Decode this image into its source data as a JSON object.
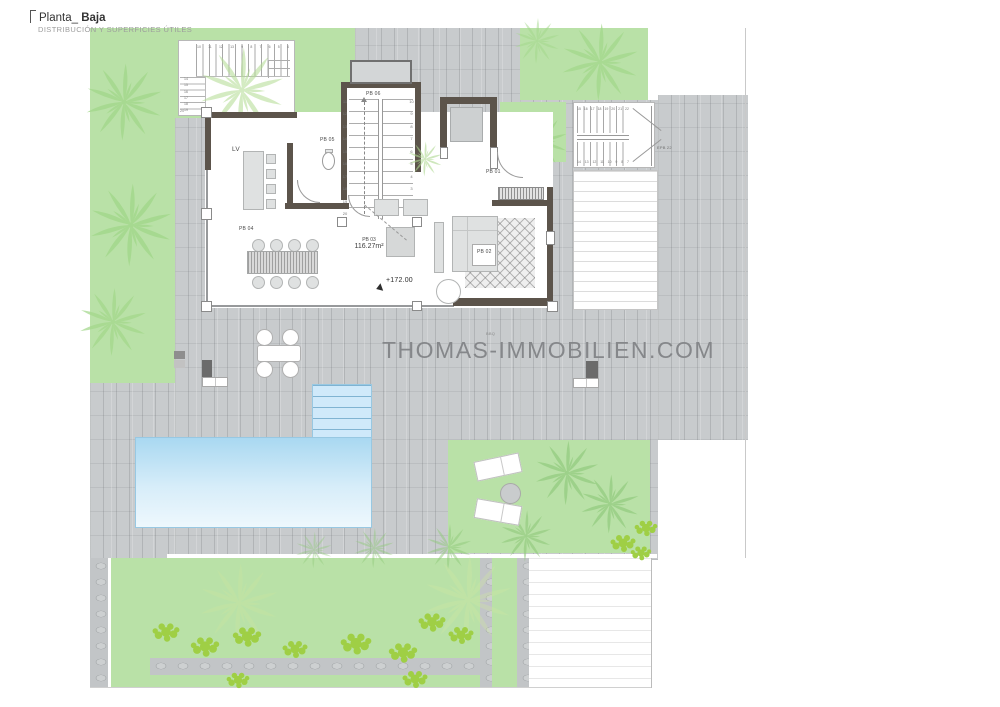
{
  "header": {
    "title_prefix": "Planta_",
    "title_main": "Baja",
    "subtitle": "DISTRIBUCIÓN Y SUPERFICIES ÚTILES"
  },
  "watermark": {
    "text": "THOMAS-IMMOBILIEN.COM"
  },
  "rooms": {
    "living_label": "LV",
    "pb01": "PB 01",
    "pb02": "PB 02",
    "pb03": "PB 03",
    "pb03_area": "116.27m²",
    "pb04": "PB 04",
    "pb05": "PB 05",
    "pb06": "PB 06"
  },
  "annotations": {
    "level_marker": "+172.00",
    "exterior_stair_label": "EPB 22",
    "bbq_label": "BBQ"
  },
  "stairs": {
    "interior_left": [
      "11",
      "12",
      "13",
      "14",
      "15",
      "16",
      "17",
      "18",
      "19",
      "20"
    ],
    "interior_right": [
      "10",
      "9",
      "8",
      "7",
      "6",
      "5",
      "4",
      "3",
      "2",
      "1"
    ],
    "entry_top": [
      "10",
      "11",
      "12",
      "13",
      "9",
      "8",
      "7",
      "6",
      "5",
      "4"
    ],
    "entry_left": [
      "14",
      "15",
      "16",
      "17",
      "18",
      "19"
    ],
    "entry_last": "20",
    "exterior_top": [
      "15",
      "16",
      "17",
      "18",
      "19",
      "20",
      "21",
      "22"
    ],
    "exterior_bottom": [
      "14",
      "13",
      "12",
      "11",
      "10",
      "9",
      "8",
      "7"
    ]
  },
  "colors": {
    "garden_green": "#b9e1a7",
    "bush_green": "#9fcf45",
    "paving_gray": "#c8cbcd",
    "wall_dark": "#5c544b",
    "pool_blue": "#a9d8f1",
    "watermark_gray": "#85878a"
  }
}
